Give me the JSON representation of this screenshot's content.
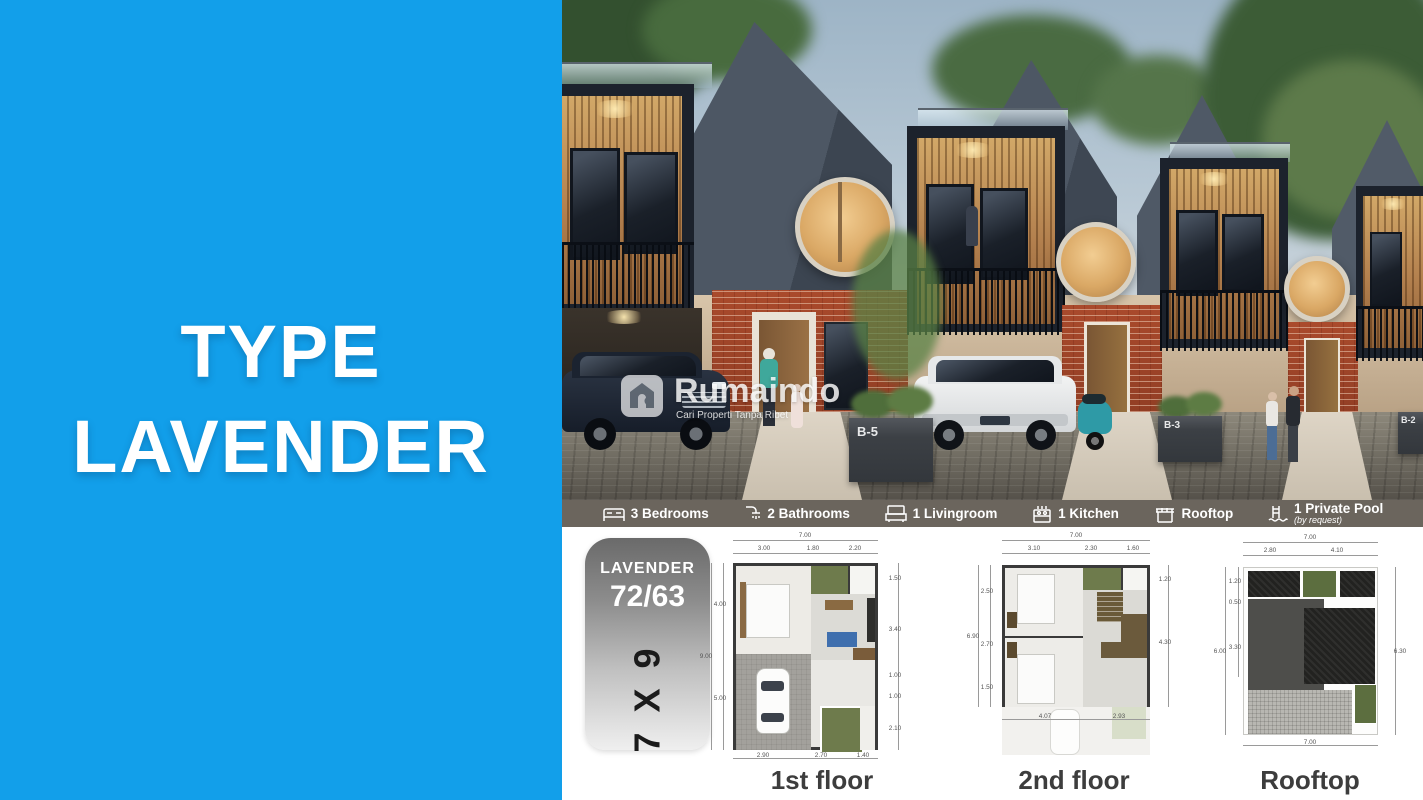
{
  "left_panel": {
    "title_line1": "TYPE",
    "title_line2": "LAVENDER"
  },
  "colors": {
    "accent_blue": "#129FEA",
    "strip_bg": "#6B655D",
    "plan_text_gray": "#3D3D3D"
  },
  "watermark": {
    "brand": "Rumaindo",
    "tagline": "Cari Properti Tanpa Ribet"
  },
  "render": {
    "unit_labels": [
      "B-5",
      "B-3",
      "B-2"
    ]
  },
  "features": {
    "items": [
      {
        "icon": "bed-icon",
        "label": "3 Bedrooms"
      },
      {
        "icon": "shower-icon",
        "label": "2 Bathrooms"
      },
      {
        "icon": "sofa-icon",
        "label": "1 Livingroom"
      },
      {
        "icon": "kitchen-icon",
        "label": "1 Kitchen"
      },
      {
        "icon": "rooftop-icon",
        "label": "Rooftop"
      },
      {
        "icon": "pool-icon",
        "label": "1 Private Pool",
        "sublabel": "(by request)"
      }
    ]
  },
  "type_card": {
    "name": "LAVENDER",
    "size": "72/63",
    "footprint": "7 X 9"
  },
  "plans": [
    {
      "label": "1st floor",
      "dims": {
        "top_total": "7.00",
        "top": [
          "3.00",
          "1.80",
          "2.20"
        ],
        "left_total": "9.00",
        "left": [
          "4.00",
          "5.00"
        ],
        "right": [
          "1.50",
          "3.40",
          "1.00",
          "1.00",
          "2.10"
        ],
        "bottom": [
          "2.90",
          "2.70",
          "1.40"
        ]
      }
    },
    {
      "label": "2nd floor",
      "dims": {
        "top_total": "7.00",
        "top": [
          "3.10",
          "2.30",
          "1.60"
        ],
        "left_total": "6.90",
        "left": [
          "2.50",
          "2.70",
          "1.50"
        ],
        "right": [
          "1.20",
          "4.30"
        ],
        "bottom": [
          "4.07",
          "2.93"
        ]
      }
    },
    {
      "label": "Rooftop",
      "dims": {
        "top_total": "7.00",
        "top": [
          "2.80",
          "4.10"
        ],
        "left_total": "6.00",
        "left": [
          "1.20",
          "0.50",
          "3.30"
        ],
        "right": [
          "6.30"
        ],
        "bottom": [
          "7.00"
        ]
      }
    }
  ]
}
